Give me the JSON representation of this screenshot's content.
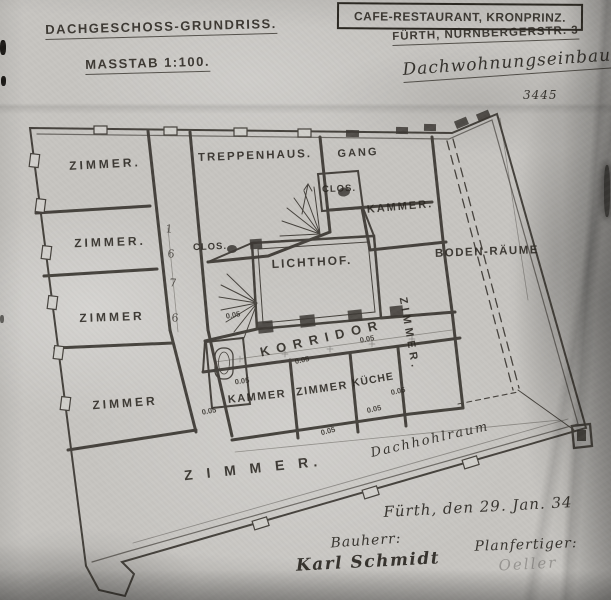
{
  "document": {
    "plan_title": "DACHGESCHOSS-GRUNDRISS.",
    "scale_label": "MASSTAB 1:100.",
    "project_box_title": "CAFE-RESTAURANT, KRONPRINZ.",
    "address_line": "FÜRTH, NÜRNBERGERSTR. 3",
    "subtitle": "Dachwohnungseinbau.",
    "plan_number": "3445"
  },
  "rooms": {
    "zimmer_nw": "ZIMMER.",
    "zimmer_w2": "ZIMMER.",
    "zimmer_w3": "ZIMMER",
    "zimmer_sw": "ZIMMER",
    "zimmer_s_large": "Z I M M E R.",
    "zimmer_center": "ZIMMER",
    "zimmer_vertical": "ZIMMER.",
    "treppenhaus": "TREPPENHAUS.",
    "gang": "GANG",
    "clos_upper": "CLOS.",
    "clos_left": "CLOS.",
    "kammer_ne": "KAMMER.",
    "kammer_center": "KAMMER",
    "lichthof": "LICHTHOF.",
    "korridor": "KORRIDOR",
    "kueche": "KÜCHE",
    "boden_raeume": "BODEN-RÄUME",
    "dachhohlraum": "Dachhohlraum"
  },
  "annotations": {
    "dim_labels": [
      "0.05",
      "0.05",
      "0.05",
      "0.05",
      "0.05",
      "0.05",
      "0.05",
      "0.05"
    ],
    "stair_marks": [
      "1",
      "6",
      "7",
      "6"
    ]
  },
  "footer": {
    "date_line": "Fürth, den 29. Jan. 34",
    "client_label": "Bauherr:",
    "client_signature": "Karl Schmidt",
    "drafter_label": "Planfertiger:",
    "drafter_signature": "Oeller"
  }
}
